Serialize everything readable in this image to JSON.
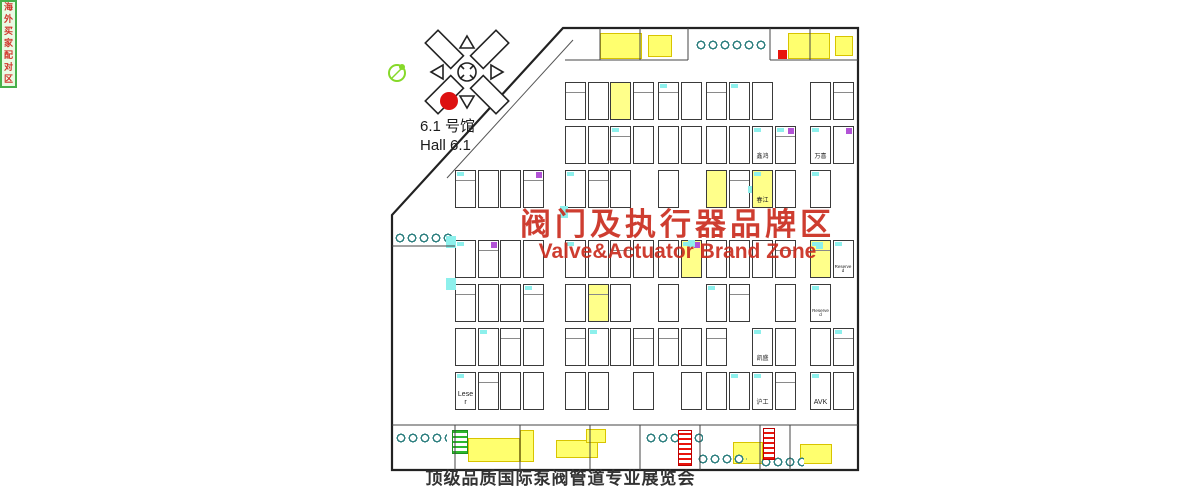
{
  "page": {
    "width": 1200,
    "height": 500,
    "bg": "#ffffff"
  },
  "hall_selector": {
    "label_zh": "6.1 号馆",
    "label_en": "Hall 6.1",
    "numbers": [
      {
        "n": "1",
        "dx": 25,
        "dy": -2
      },
      {
        "n": "2",
        "dx": 19,
        "dy": -24
      },
      {
        "n": "3",
        "dx": -11,
        "dy": -26
      },
      {
        "n": "4",
        "dx": -26,
        "dy": -5
      },
      {
        "n": "5",
        "dx": -23,
        "dy": 13
      },
      {
        "n": "6",
        "dx": -11,
        "dy": 29
      },
      {
        "n": "7",
        "dx": 14,
        "dy": 29
      },
      {
        "n": "8",
        "dx": 22,
        "dy": 15
      }
    ],
    "active": "6",
    "active_color": "#dd1111",
    "marker": {
      "dx": -18,
      "dy": 29,
      "r": 9
    }
  },
  "zone_title": {
    "zh": "阀门及执行器品牌区",
    "en": "Valve&Actuator Brand Zone",
    "color": "#ca2c1e"
  },
  "caption": "顶级品质国际泵阀管道专业展览会",
  "special_zones": {
    "overseas_buyers": "海外买家配对区"
  },
  "booth_labels": [
    {
      "x": 752,
      "y": 126,
      "c": 0,
      "text": "鑫鸿"
    },
    {
      "x": 810,
      "y": 126,
      "c": 0,
      "text": "万喜"
    },
    {
      "x": 752,
      "y": 170,
      "c": 0,
      "text": "春江"
    },
    {
      "x": 810,
      "y": 240,
      "c": 1,
      "text": "Reserved"
    },
    {
      "x": 810,
      "y": 284,
      "c": 0,
      "text": "Reserved"
    },
    {
      "x": 752,
      "y": 328,
      "c": 0,
      "text": "凯盛"
    },
    {
      "x": 752,
      "y": 372,
      "c": 0,
      "text": "沪工"
    },
    {
      "x": 810,
      "y": 372,
      "c": 0,
      "text": "AVK"
    },
    {
      "x": 455,
      "y": 372,
      "c": 0,
      "text": "Leser"
    }
  ],
  "floorplan": {
    "outline": "563,28 858,28 858,470 392,470 392,215",
    "rows": [
      82,
      126,
      170,
      240,
      284,
      328,
      372
    ],
    "cell": {
      "w": 21,
      "h": 38,
      "pitch": 22.5
    },
    "col_groups": [
      {
        "x": 565,
        "cols": 4,
        "rows": "all"
      },
      {
        "x": 658,
        "cols": 2,
        "rows": "all"
      },
      {
        "x": 706,
        "cols": 2,
        "rows": "all"
      },
      {
        "x": 752,
        "cols": 2,
        "rows": "all"
      },
      {
        "x": 810,
        "cols": 2,
        "rows": "all"
      },
      {
        "x": 455,
        "cols": 4,
        "rows": [
          170,
          240,
          284,
          328,
          372
        ]
      }
    ],
    "scallops": [
      {
        "x": 695,
        "y": 34,
        "w": 72
      },
      {
        "x": 394,
        "y": 227,
        "w": 60
      },
      {
        "x": 395,
        "y": 427,
        "w": 52
      },
      {
        "x": 645,
        "y": 427,
        "w": 58
      },
      {
        "x": 697,
        "y": 448,
        "w": 50
      },
      {
        "x": 760,
        "y": 451,
        "w": 44
      }
    ],
    "yellow_patches": [
      {
        "x": 600,
        "y": 33,
        "w": 40,
        "h": 24
      },
      {
        "x": 648,
        "y": 35,
        "w": 22,
        "h": 20
      },
      {
        "x": 788,
        "y": 33,
        "w": 40,
        "h": 24
      },
      {
        "x": 835,
        "y": 36,
        "w": 16,
        "h": 18
      },
      {
        "x": 468,
        "y": 438,
        "w": 50,
        "h": 22
      },
      {
        "x": 556,
        "y": 440,
        "w": 40,
        "h": 16
      },
      {
        "x": 586,
        "y": 429,
        "w": 18,
        "h": 12
      },
      {
        "x": 733,
        "y": 442,
        "w": 28,
        "h": 20
      },
      {
        "x": 800,
        "y": 444,
        "w": 30,
        "h": 18
      },
      {
        "x": 520,
        "y": 430,
        "w": 12,
        "h": 30
      }
    ],
    "red_hatches": [
      {
        "x": 678,
        "y": 430,
        "w": 12,
        "h": 34
      },
      {
        "x": 763,
        "y": 428,
        "w": 10,
        "h": 30
      }
    ],
    "green_hatches": [
      {
        "x": 452,
        "y": 430,
        "w": 14,
        "h": 22
      }
    ],
    "red_cells": [
      {
        "x": 778,
        "y": 50,
        "w": 9,
        "h": 9
      }
    ],
    "aqua_marks": [
      {
        "x": 446,
        "y": 236,
        "w": 10,
        "h": 12
      },
      {
        "x": 446,
        "y": 278,
        "w": 10,
        "h": 12
      },
      {
        "x": 560,
        "y": 206,
        "w": 8,
        "h": 12
      }
    ],
    "magenta_marks": [
      {
        "x": 688,
        "y": 240
      },
      {
        "x": 816,
        "y": 242
      },
      {
        "x": 748,
        "y": 186
      }
    ],
    "corridor": {
      "x": 415,
      "y": 96,
      "w": 156,
      "h": 13,
      "angle": -48.6
    },
    "corridor2": {
      "x": 432,
      "y": 162,
      "w": 42,
      "h": 9,
      "angle": -48.6
    },
    "red_tick": {
      "x": 510,
      "y": 112,
      "w": 4,
      "h": 26,
      "angle": -48.6
    },
    "green_strip": {
      "x": 392,
      "y": 262,
      "count": 7,
      "cw": 17,
      "ch": 19
    },
    "buyers_box": {
      "x": 437,
      "y": 297,
      "w": 26,
      "h": 102
    },
    "center_green": {
      "x": 608,
      "y": 234,
      "w": 30,
      "h": 58
    },
    "star": {
      "x": 734,
      "y": 367
    },
    "arrows": [
      {
        "x": 425,
        "dir": "up",
        "style": "solid"
      },
      {
        "x": 527,
        "dir": "down",
        "style": "solid"
      },
      {
        "x": 628,
        "dir": "up",
        "style": "hatch"
      },
      {
        "x": 724,
        "dir": "up",
        "style": "solid"
      },
      {
        "x": 838,
        "dir": "up",
        "style": "solid"
      }
    ],
    "arrow_color": "#e8140c"
  }
}
